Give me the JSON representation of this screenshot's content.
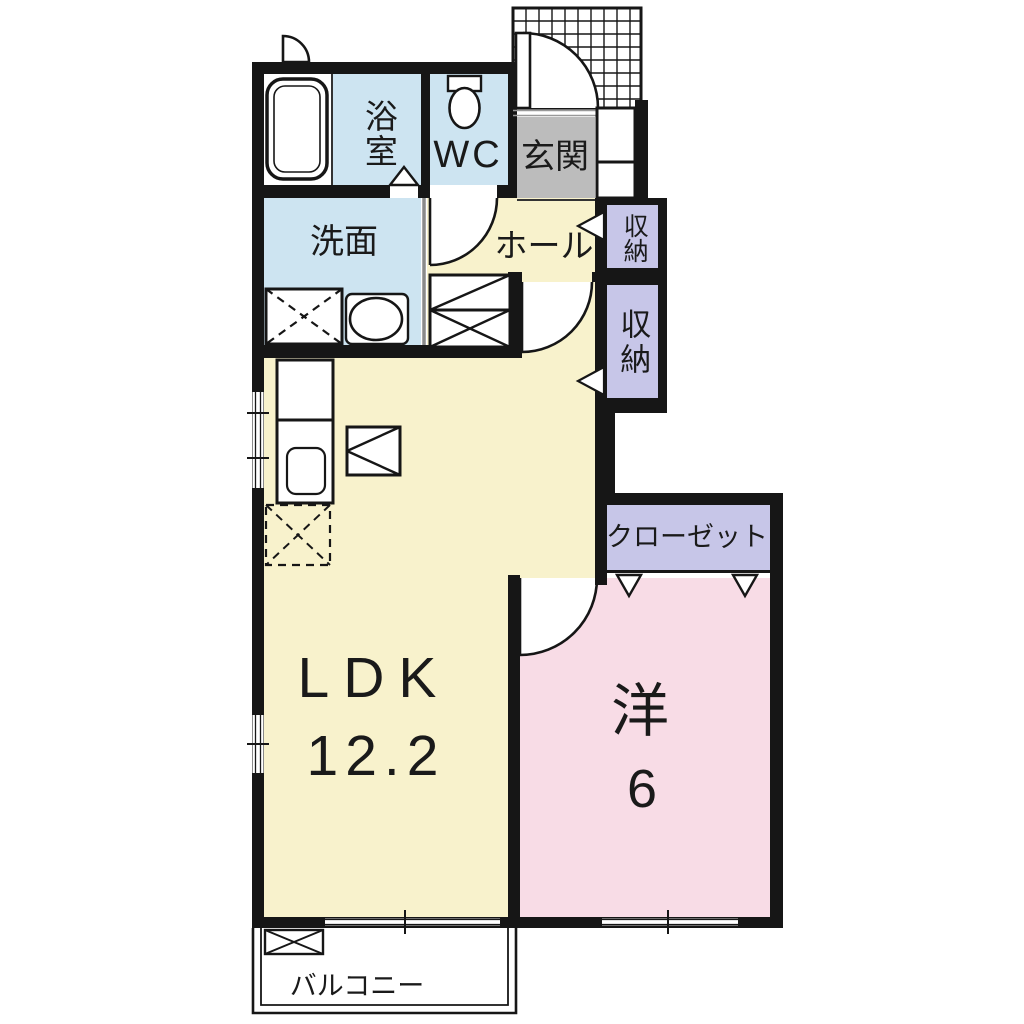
{
  "plan": {
    "rooms": {
      "bathroom": {
        "label": "浴室"
      },
      "toilet": {
        "label": "WC"
      },
      "entrance": {
        "label": "玄関"
      },
      "washroom": {
        "label": "洗面"
      },
      "hall": {
        "label": "ホール"
      },
      "storage_upper": {
        "label": "収納"
      },
      "storage_lower": {
        "label": "収納"
      },
      "closet": {
        "label": "クローゼット"
      },
      "ldk": {
        "label": "LDK",
        "size": "12.2"
      },
      "western_room": {
        "label": "洋",
        "size": "6"
      },
      "balcony": {
        "label": "バルコニー"
      }
    },
    "colors": {
      "wet_area": "#cde4f1",
      "living": "#f8f2cc",
      "bedroom": "#f8dce6",
      "storage": "#c7c6e8",
      "entrance_floor": "#bcbcbc",
      "wall": "#161616",
      "background": "#ffffff"
    },
    "symbols": {
      "bathtub": "rounded rectangle outline",
      "toilet": "tank + oval bowl outline",
      "sink": "oval basin in counter",
      "washing_machine": "box with dashed X",
      "refrigerator_space": "dashed box with dashed X",
      "kitchen_stove": "box with left-pointing triangle",
      "door_swing": "quarter-circle arc",
      "folding_door": "triangle marker",
      "window": "white slot in wall with tick",
      "porch_tile": "cross-hatch grid",
      "balcony_rail": "double line"
    }
  }
}
